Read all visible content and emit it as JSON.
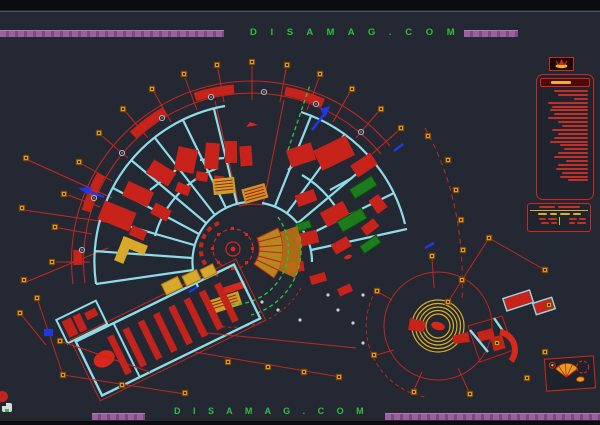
{
  "watermark": {
    "top_text": "D I S A M A G . C O M",
    "bottom_text": "D I S A M A G . C O M"
  },
  "colors": {
    "background": "#232833",
    "line_red": "#c8281e",
    "fill_red": "#d8281c",
    "wall_cyan": "#8fdce8",
    "stair_yellow": "#d8a828",
    "marker_orange": "#e89418",
    "green_dashed": "#2fbf3a",
    "green_fill": "#1d7a1d",
    "purple_bar": "#9c5fa0",
    "watermark_green": "#2fbf3a",
    "annotation_blue": "#2038e8"
  },
  "legend_panel": {
    "row_widths": [
      34,
      30,
      14,
      40,
      36,
      38,
      34,
      40,
      30,
      26,
      36,
      30,
      34,
      38,
      28,
      24,
      30,
      34,
      22,
      30,
      32,
      26,
      28,
      20
    ]
  },
  "schedule_table": {
    "title_chunks": [
      16,
      22
    ],
    "header_chunks": [
      9,
      7,
      10,
      8
    ],
    "left_rows": [
      [
        7,
        9
      ],
      [
        8,
        6
      ]
    ],
    "right_rows": [
      [
        8,
        7
      ],
      [
        6,
        9
      ]
    ]
  },
  "markers": {
    "orange_squares": [
      [
        52,
        262
      ],
      [
        55,
        227
      ],
      [
        64,
        194
      ],
      [
        79,
        162
      ],
      [
        99,
        133
      ],
      [
        123,
        109
      ],
      [
        152,
        89
      ],
      [
        184,
        74
      ],
      [
        217,
        65
      ],
      [
        252,
        62
      ],
      [
        287,
        65
      ],
      [
        320,
        74
      ],
      [
        352,
        89
      ],
      [
        381,
        109
      ],
      [
        401,
        128
      ],
      [
        428,
        136
      ],
      [
        448,
        160
      ],
      [
        456,
        190
      ],
      [
        461,
        220
      ],
      [
        463,
        250
      ],
      [
        462,
        280
      ],
      [
        26,
        158
      ],
      [
        22,
        208
      ],
      [
        24,
        280
      ],
      [
        20,
        313
      ],
      [
        37,
        298
      ],
      [
        60,
        341
      ],
      [
        63,
        375
      ],
      [
        122,
        385
      ],
      [
        185,
        393
      ],
      [
        228,
        362
      ],
      [
        268,
        367
      ],
      [
        304,
        372
      ],
      [
        339,
        377
      ],
      [
        432,
        256
      ],
      [
        377,
        291
      ],
      [
        374,
        355
      ],
      [
        414,
        392
      ],
      [
        470,
        394
      ],
      [
        497,
        343
      ],
      [
        527,
        378
      ],
      [
        545,
        352
      ],
      [
        549,
        305
      ],
      [
        448,
        302
      ],
      [
        489,
        238
      ],
      [
        545,
        270
      ]
    ],
    "grid_bubbles": [
      [
        82,
        250
      ],
      [
        94,
        198
      ],
      [
        122,
        153
      ],
      [
        162,
        118
      ],
      [
        211,
        97
      ],
      [
        264,
        92
      ],
      [
        316,
        104
      ],
      [
        361,
        132
      ]
    ],
    "gray_dots": [
      [
        278,
        310
      ],
      [
        328,
        295
      ],
      [
        363,
        295
      ],
      [
        353,
        323
      ],
      [
        363,
        343
      ],
      [
        300,
        320
      ],
      [
        262,
        302
      ],
      [
        338,
        310
      ]
    ]
  }
}
